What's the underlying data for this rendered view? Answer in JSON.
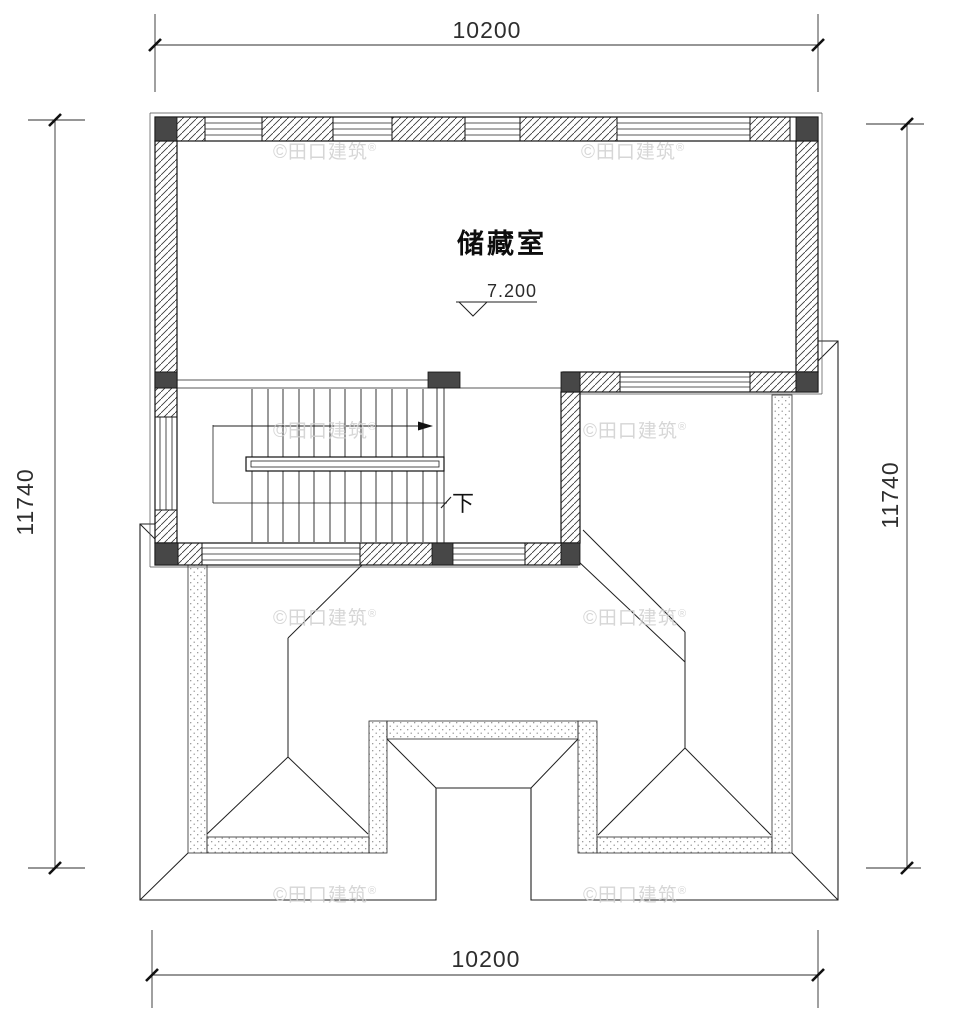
{
  "drawing": {
    "room_label": "储藏室",
    "elevation": "7.200",
    "stair_down_label": "下",
    "dim_top": "10200",
    "dim_bottom": "10200",
    "dim_left": "11740",
    "dim_right": "11740",
    "watermark_text": "©田口建筑",
    "watermark_reg": "®"
  }
}
